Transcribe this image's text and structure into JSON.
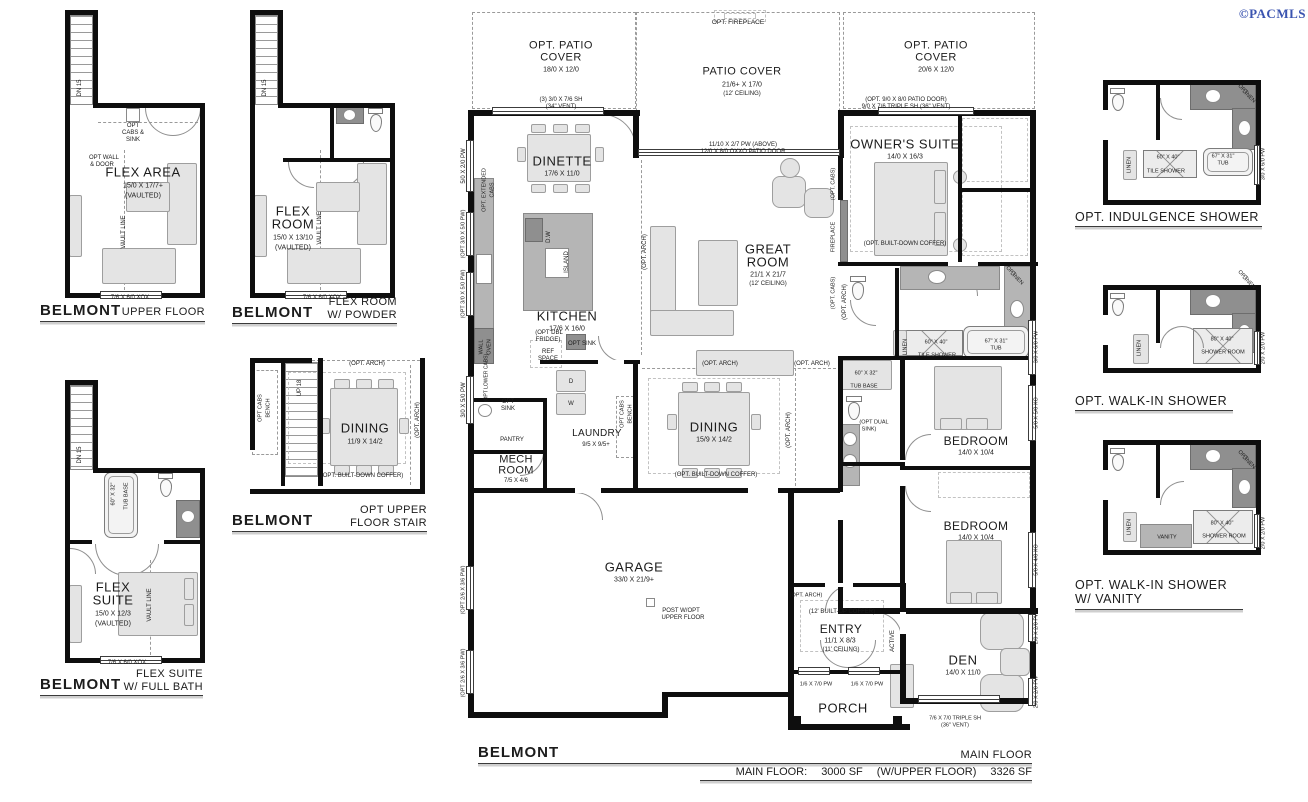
{
  "copyright": "©PACMLS",
  "plans": {
    "upper_floor": {
      "brand": "BELMONT",
      "label": "UPPER FLOOR"
    },
    "flex_powder": {
      "brand": "BELMONT",
      "label": "FLEX ROOM",
      "label2": "W/ POWDER"
    },
    "flex_suite": {
      "brand": "BELMONT",
      "label": "FLEX SUITE",
      "label2": "W/ FULL BATH"
    },
    "opt_stair": {
      "brand": "BELMONT",
      "label": "OPT UPPER",
      "label2": "FLOOR STAIR"
    },
    "indulgence": {
      "label": "OPT. INDULGENCE SHOWER"
    },
    "walkin": {
      "label": "OPT. WALK-IN SHOWER"
    },
    "walkin_vanity": {
      "label": "OPT. WALK-IN SHOWER",
      "label2": "W/ VANITY"
    }
  },
  "footer": {
    "brand": "BELMONT",
    "floor_label": "MAIN FLOOR",
    "area_label": "MAIN FLOOR:",
    "area_main": "3000 SF",
    "area_with": "(W/UPPER FLOOR)",
    "area_total": "3326 SF"
  },
  "labels": [
    {
      "t": "FLEX AREA",
      "x": 143,
      "y": 172,
      "fs": 13,
      "sp": 0.5,
      "n": "room-flex-area"
    },
    {
      "t": "15/0 X 17/7+",
      "x": 143,
      "y": 186,
      "fs": 7
    },
    {
      "t": "(VAULTED)",
      "x": 143,
      "y": 196,
      "fs": 7
    },
    {
      "t": "OPT",
      "x": 133,
      "y": 126,
      "fs": 6
    },
    {
      "t": "CABS &",
      "x": 133,
      "y": 133,
      "fs": 6
    },
    {
      "t": "SINK",
      "x": 133,
      "y": 140,
      "fs": 6
    },
    {
      "t": "OPT WALL",
      "x": 104,
      "y": 158,
      "fs": 6
    },
    {
      "t": "& DOOR",
      "x": 102,
      "y": 165,
      "fs": 6
    },
    {
      "t": "VAULT LINE",
      "x": 124,
      "y": 232,
      "fs": 6,
      "r": -90
    },
    {
      "t": "DN 15",
      "x": 80,
      "y": 88,
      "fs": 6,
      "r": -90
    },
    {
      "t": "7/6 X 6/0 XOX",
      "x": 130,
      "y": 298,
      "fs": 6
    },
    {
      "t": "FLEX",
      "x": 293,
      "y": 211,
      "fs": 13,
      "sp": 0.5,
      "n": "room-flex-room"
    },
    {
      "t": "ROOM",
      "x": 293,
      "y": 224,
      "fs": 13,
      "sp": 0.5
    },
    {
      "t": "15/0 X 13/10",
      "x": 293,
      "y": 238,
      "fs": 7
    },
    {
      "t": "(VAULTED)",
      "x": 293,
      "y": 248,
      "fs": 7
    },
    {
      "t": "VAULT LINE",
      "x": 320,
      "y": 228,
      "fs": 6,
      "r": -90
    },
    {
      "t": "DN 15",
      "x": 265,
      "y": 88,
      "fs": 6,
      "r": -90
    },
    {
      "t": "7/6 X 6/0 XOX",
      "x": 322,
      "y": 298,
      "fs": 6
    },
    {
      "t": "FLEX",
      "x": 113,
      "y": 587,
      "fs": 13,
      "sp": 0.5,
      "n": "room-flex-suite"
    },
    {
      "t": "SUITE",
      "x": 113,
      "y": 600,
      "fs": 13,
      "sp": 0.5
    },
    {
      "t": "15/0 X 12/3",
      "x": 113,
      "y": 614,
      "fs": 7
    },
    {
      "t": "(VAULTED)",
      "x": 113,
      "y": 624,
      "fs": 7
    },
    {
      "t": "60\" X 32\"",
      "x": 114,
      "y": 494,
      "fs": 5.5,
      "r": -90
    },
    {
      "t": "TUB BASE",
      "x": 127,
      "y": 496,
      "fs": 5.5,
      "r": -90
    },
    {
      "t": "VAULT LINE",
      "x": 150,
      "y": 605,
      "fs": 6,
      "r": -90
    },
    {
      "t": "DN 15",
      "x": 80,
      "y": 455,
      "fs": 6,
      "r": -90
    },
    {
      "t": "7/6 X 6/0 XOX",
      "x": 127,
      "y": 663,
      "fs": 6
    },
    {
      "t": "(OPT. ARCH)",
      "x": 367,
      "y": 364,
      "fs": 6
    },
    {
      "t": "OPT CABS",
      "x": 261,
      "y": 408,
      "fs": 5.5,
      "r": -90
    },
    {
      "t": "BENCH",
      "x": 269,
      "y": 408,
      "fs": 5.5,
      "r": -90
    },
    {
      "t": "UP 18",
      "x": 300,
      "y": 388,
      "fs": 6,
      "r": -90
    },
    {
      "t": "DINING",
      "x": 365,
      "y": 428,
      "fs": 13,
      "sp": 0.5,
      "n": "room-dining-opt"
    },
    {
      "t": "11/9 X 14/2",
      "x": 365,
      "y": 442,
      "fs": 7
    },
    {
      "t": "(OPT. BUILT-DOWN COFFER)",
      "x": 362,
      "y": 476,
      "fs": 6
    },
    {
      "t": "(OPT. ARCH)",
      "x": 418,
      "y": 420,
      "fs": 6,
      "r": -90
    },
    {
      "t": "OPT. PATIO",
      "x": 561,
      "y": 46,
      "fs": 11,
      "sp": 0.5,
      "n": "area-opt-patio-cover-left"
    },
    {
      "t": "COVER",
      "x": 561,
      "y": 58,
      "fs": 11,
      "sp": 0.5
    },
    {
      "t": "18/0 X 12/0",
      "x": 561,
      "y": 70,
      "fs": 7
    },
    {
      "t": "(3) 3/0 X 7/6 SH",
      "x": 561,
      "y": 100,
      "fs": 6
    },
    {
      "t": "(34\" VENT)",
      "x": 561,
      "y": 107,
      "fs": 6
    },
    {
      "t": "OPT. FIREPLACE",
      "x": 738,
      "y": 23,
      "fs": 6.5
    },
    {
      "t": "PATIO COVER",
      "x": 742,
      "y": 72,
      "fs": 11,
      "sp": 0.5,
      "n": "area-patio-cover"
    },
    {
      "t": "21/6+ X 17/0",
      "x": 742,
      "y": 85,
      "fs": 7
    },
    {
      "t": "(12' CEILING)",
      "x": 742,
      "y": 94,
      "fs": 6
    },
    {
      "t": "11/10 X 2/7 PW (ABOVE)",
      "x": 743,
      "y": 145,
      "fs": 6
    },
    {
      "t": "12/0 X 8/0 OXXO PATIO DOOR",
      "x": 743,
      "y": 152,
      "fs": 6
    },
    {
      "t": "OPT. PATIO",
      "x": 936,
      "y": 46,
      "fs": 11,
      "sp": 0.5,
      "n": "area-opt-patio-cover-right"
    },
    {
      "t": "COVER",
      "x": 936,
      "y": 58,
      "fs": 11,
      "sp": 0.5
    },
    {
      "t": "20/6 X 12/0",
      "x": 936,
      "y": 70,
      "fs": 7
    },
    {
      "t": "(OPT. 9/0 X 8/0 PATIO DOOR)",
      "x": 906,
      "y": 100,
      "fs": 6
    },
    {
      "t": "9/0 X 7/6 TRIPLE SH (36\" VENT)",
      "x": 906,
      "y": 107,
      "fs": 6
    },
    {
      "t": "DINETTE",
      "x": 562,
      "y": 161,
      "fs": 13,
      "sp": 0.5,
      "n": "room-dinette"
    },
    {
      "t": "17/6 X 11/0",
      "x": 562,
      "y": 174,
      "fs": 7
    },
    {
      "t": "KITCHEN",
      "x": 567,
      "y": 316,
      "fs": 13,
      "sp": 0.5,
      "n": "room-kitchen"
    },
    {
      "t": "17/6 X 16/0",
      "x": 567,
      "y": 329,
      "fs": 7
    },
    {
      "t": "ISLAND",
      "x": 567,
      "y": 262,
      "fs": 6,
      "r": -90
    },
    {
      "t": "D.W",
      "x": 549,
      "y": 237,
      "fs": 6,
      "r": -90
    },
    {
      "t": "(OPT DBL",
      "x": 549,
      "y": 333,
      "fs": 6
    },
    {
      "t": "FRIDGE)",
      "x": 548,
      "y": 340,
      "fs": 6
    },
    {
      "t": "REF",
      "x": 548,
      "y": 352,
      "fs": 6
    },
    {
      "t": "SPACE",
      "x": 548,
      "y": 359,
      "fs": 6
    },
    {
      "t": "OPT SINK",
      "x": 582,
      "y": 344,
      "fs": 6
    },
    {
      "t": "GREAT",
      "x": 768,
      "y": 249,
      "fs": 13,
      "sp": 0.5,
      "n": "room-great-room"
    },
    {
      "t": "ROOM",
      "x": 768,
      "y": 262,
      "fs": 13,
      "sp": 0.5
    },
    {
      "t": "21/1 X 21/7",
      "x": 768,
      "y": 275,
      "fs": 7
    },
    {
      "t": "(12' CEILING)",
      "x": 768,
      "y": 284,
      "fs": 6
    },
    {
      "t": "FIREPLACE",
      "x": 834,
      "y": 237,
      "fs": 5.5,
      "r": -90
    },
    {
      "t": "(OPT. CABS)",
      "x": 834,
      "y": 184,
      "fs": 5.5,
      "r": -90
    },
    {
      "t": "(OPT. CABS)",
      "x": 834,
      "y": 293,
      "fs": 5.5,
      "r": -90
    },
    {
      "t": "OWNER'S SUITE",
      "x": 905,
      "y": 144,
      "fs": 13,
      "sp": 0.5,
      "n": "room-owners-suite"
    },
    {
      "t": "14/0 X 16/3",
      "x": 905,
      "y": 157,
      "fs": 7
    },
    {
      "t": "(OPT. BUILT-DOWN COFFER)",
      "x": 905,
      "y": 244,
      "fs": 6
    },
    {
      "t": "(OPT. ARCH)",
      "x": 645,
      "y": 252,
      "fs": 6,
      "r": -90
    },
    {
      "t": "(OPT. ARCH)",
      "x": 845,
      "y": 302,
      "fs": 6,
      "r": -90
    },
    {
      "t": "(OPT. ARCH)",
      "x": 720,
      "y": 364,
      "fs": 6
    },
    {
      "t": "(OPT. ARCH)",
      "x": 812,
      "y": 364,
      "fs": 6
    },
    {
      "t": "(OPT. ARCH)",
      "x": 789,
      "y": 430,
      "fs": 6,
      "r": -90
    },
    {
      "t": "(OPT. ARCH)",
      "x": 806,
      "y": 596,
      "fs": 5.5
    },
    {
      "t": "DINING",
      "x": 714,
      "y": 427,
      "fs": 13,
      "sp": 0.5,
      "n": "room-dining"
    },
    {
      "t": "15/9 X 14/2",
      "x": 714,
      "y": 440,
      "fs": 7
    },
    {
      "t": "(OPT. BUILT-DOWN COFFER)",
      "x": 716,
      "y": 475,
      "fs": 6
    },
    {
      "t": "OPT CABS",
      "x": 623,
      "y": 414,
      "fs": 5.5,
      "r": -90
    },
    {
      "t": "BENCH",
      "x": 631,
      "y": 414,
      "fs": 5.5,
      "r": -90
    },
    {
      "t": "LAUNDRY",
      "x": 597,
      "y": 434,
      "fs": 10,
      "sp": 0.3,
      "n": "room-laundry"
    },
    {
      "t": "9/5 X 9/5+",
      "x": 596,
      "y": 445,
      "fs": 6
    },
    {
      "t": "D",
      "x": 571,
      "y": 382,
      "fs": 6
    },
    {
      "t": "W",
      "x": 571,
      "y": 404,
      "fs": 6
    },
    {
      "t": "PANTRY",
      "x": 512,
      "y": 440,
      "fs": 6
    },
    {
      "t": "OPT",
      "x": 508,
      "y": 402,
      "fs": 6
    },
    {
      "t": "SINK",
      "x": 508,
      "y": 409,
      "fs": 6
    },
    {
      "t": "MECH",
      "x": 516,
      "y": 460,
      "fs": 11,
      "sp": 0.3,
      "n": "room-mech"
    },
    {
      "t": "ROOM",
      "x": 516,
      "y": 471,
      "fs": 11,
      "sp": 0.3
    },
    {
      "t": "7/5 X 4/6",
      "x": 516,
      "y": 481,
      "fs": 6
    },
    {
      "t": "WALL",
      "x": 482,
      "y": 347,
      "fs": 5.5,
      "r": -90
    },
    {
      "t": "OVEN",
      "x": 490,
      "y": 347,
      "fs": 5.5,
      "r": -90
    },
    {
      "t": "(OPT LOWER CABS)",
      "x": 487,
      "y": 378,
      "fs": 5,
      "r": -90
    },
    {
      "t": "OPT. EXTENDED",
      "x": 485,
      "y": 190,
      "fs": 5.5,
      "r": -90
    },
    {
      "t": "CABS",
      "x": 493,
      "y": 190,
      "fs": 5.5,
      "r": -90
    },
    {
      "t": "5/0 X 2/0 PW",
      "x": 464,
      "y": 166,
      "fs": 6,
      "r": -90
    },
    {
      "t": "(OPT 3/0 X 5/0 PW)",
      "x": 464,
      "y": 234,
      "fs": 5.5,
      "r": -90
    },
    {
      "t": "(OPT 3/0 X 5/0 PW)",
      "x": 464,
      "y": 294,
      "fs": 5.5,
      "r": -90
    },
    {
      "t": "3/0 X 5/0 PW",
      "x": 464,
      "y": 400,
      "fs": 6,
      "r": -90
    },
    {
      "t": "(OPT 2/6 X 3/6 PW)",
      "x": 464,
      "y": 590,
      "fs": 5.5,
      "r": -90
    },
    {
      "t": "(OPT 2/6 X 3/6 PW)",
      "x": 464,
      "y": 673,
      "fs": 5.5,
      "r": -90
    },
    {
      "t": "GARAGE",
      "x": 634,
      "y": 567,
      "fs": 13,
      "sp": 0.5,
      "n": "room-garage"
    },
    {
      "t": "33/0 X 21/9+",
      "x": 634,
      "y": 580,
      "fs": 7
    },
    {
      "t": "POST W/OPT",
      "x": 681,
      "y": 611,
      "fs": 6
    },
    {
      "t": "UPPER FLOOR",
      "x": 683,
      "y": 618,
      "fs": 6
    },
    {
      "t": "ENTRY",
      "x": 841,
      "y": 629,
      "fs": 12,
      "sp": 0.4,
      "n": "room-entry"
    },
    {
      "t": "11/1 X 8/3",
      "x": 840,
      "y": 641,
      "fs": 7
    },
    {
      "t": "(11' CEILING)",
      "x": 841,
      "y": 650,
      "fs": 6
    },
    {
      "t": "(12' BUILT-UP COFFER)",
      "x": 842,
      "y": 612,
      "fs": 6
    },
    {
      "t": "ACTIVE",
      "x": 893,
      "y": 641,
      "fs": 6,
      "r": -90
    },
    {
      "t": "1/6 X 7/0 PW",
      "x": 816,
      "y": 685,
      "fs": 5.5
    },
    {
      "t": "1/6 X 7/0 PW",
      "x": 867,
      "y": 685,
      "fs": 5.5
    },
    {
      "t": "PORCH",
      "x": 843,
      "y": 708,
      "fs": 13,
      "sp": 0.5,
      "n": "room-porch"
    },
    {
      "t": "DEN",
      "x": 963,
      "y": 660,
      "fs": 13,
      "sp": 0.5,
      "n": "room-den"
    },
    {
      "t": "14/0 X 11/0",
      "x": 963,
      "y": 673,
      "fs": 7
    },
    {
      "t": "7/6 X 7/0 TRIPLE SH",
      "x": 955,
      "y": 719,
      "fs": 5.5
    },
    {
      "t": "(36\" VENT)",
      "x": 955,
      "y": 726,
      "fs": 5.5
    },
    {
      "t": "BEDROOM",
      "x": 976,
      "y": 441,
      "fs": 12,
      "sp": 0.4,
      "n": "room-bedroom-1"
    },
    {
      "t": "14/0 X 10/4",
      "x": 976,
      "y": 453,
      "fs": 7
    },
    {
      "t": "BEDROOM",
      "x": 976,
      "y": 526,
      "fs": 12,
      "sp": 0.4,
      "n": "room-bedroom-2"
    },
    {
      "t": "14/0 X 10/4",
      "x": 976,
      "y": 538,
      "fs": 7
    },
    {
      "t": "60\" X 40\"",
      "x": 936,
      "y": 343,
      "fs": 5.5
    },
    {
      "t": "TILE SHOWER",
      "x": 937,
      "y": 356,
      "fs": 5.5
    },
    {
      "t": "67\" X 31\"",
      "x": 996,
      "y": 342,
      "fs": 5.5
    },
    {
      "t": "TUB",
      "x": 996,
      "y": 349,
      "fs": 5.5
    },
    {
      "t": "LINEN",
      "x": 906,
      "y": 347,
      "fs": 5.5,
      "r": -90
    },
    {
      "t": "OPT",
      "x": 1010,
      "y": 272,
      "fs": 5.5,
      "r": 45
    },
    {
      "t": "LINEN",
      "x": 1016,
      "y": 279,
      "fs": 5.5,
      "r": 45
    },
    {
      "t": "3/0 X 6/0 PW",
      "x": 1037,
      "y": 347,
      "fs": 5.5,
      "r": -90
    },
    {
      "t": "5/0 X 5/0 XO",
      "x": 1037,
      "y": 413,
      "fs": 5.5,
      "r": -90
    },
    {
      "t": "5/0 X 4/0 XO",
      "x": 1037,
      "y": 560,
      "fs": 5.5,
      "r": -90
    },
    {
      "t": "2/0 X 2/0 PW",
      "x": 1037,
      "y": 628,
      "fs": 5.5,
      "r": -90
    },
    {
      "t": "2/0 X 2/0 PW",
      "x": 1037,
      "y": 692,
      "fs": 5.5,
      "r": -90
    },
    {
      "t": "60\" X 32\"",
      "x": 866,
      "y": 374,
      "fs": 5.5
    },
    {
      "t": "TUB BASE",
      "x": 864,
      "y": 387,
      "fs": 5.5
    },
    {
      "t": "(OPT DUAL",
      "x": 874,
      "y": 423,
      "fs": 5.5
    },
    {
      "t": "SINK)",
      "x": 869,
      "y": 430,
      "fs": 5.5
    },
    {
      "t": "60\" X 40\"",
      "x": 1168,
      "y": 158,
      "fs": 5.5
    },
    {
      "t": "TILE SHOWER",
      "x": 1166,
      "y": 172,
      "fs": 5.5
    },
    {
      "t": "67\" X 31\"",
      "x": 1223,
      "y": 157,
      "fs": 5.5
    },
    {
      "t": "TUB",
      "x": 1223,
      "y": 164,
      "fs": 5.5
    },
    {
      "t": "LINEN",
      "x": 1130,
      "y": 165,
      "fs": 5.5,
      "r": -90
    },
    {
      "t": "OPT",
      "x": 1242,
      "y": 90,
      "fs": 5.5,
      "r": 45
    },
    {
      "t": "LINEN",
      "x": 1248,
      "y": 97,
      "fs": 5.5,
      "r": 45
    },
    {
      "t": "3/0 X 6/0 PW",
      "x": 1264,
      "y": 164,
      "fs": 5.5,
      "r": -90
    },
    {
      "t": "80\" X 40\"",
      "x": 1222,
      "y": 340,
      "fs": 5.5
    },
    {
      "t": "SHOWER ROOM",
      "x": 1223,
      "y": 353,
      "fs": 5.5
    },
    {
      "t": "LINEN",
      "x": 1140,
      "y": 348,
      "fs": 5.5,
      "r": -90
    },
    {
      "t": "OPT",
      "x": 1242,
      "y": 276,
      "fs": 5.5,
      "r": 45
    },
    {
      "t": "LINEN",
      "x": 1248,
      "y": 283,
      "fs": 5.5,
      "r": 45
    },
    {
      "t": "2/0 X 2/0 PW",
      "x": 1264,
      "y": 348,
      "fs": 5.5,
      "r": -90
    },
    {
      "t": "80\" X 40\"",
      "x": 1222,
      "y": 524,
      "fs": 5.5
    },
    {
      "t": "SHOWER ROOM",
      "x": 1224,
      "y": 537,
      "fs": 5.5
    },
    {
      "t": "VANITY",
      "x": 1167,
      "y": 538,
      "fs": 5.5
    },
    {
      "t": "LINEN",
      "x": 1130,
      "y": 527,
      "fs": 5.5,
      "r": -90
    },
    {
      "t": "OPT",
      "x": 1242,
      "y": 456,
      "fs": 5.5,
      "r": 45
    },
    {
      "t": "LINEN",
      "x": 1248,
      "y": 463,
      "fs": 5.5,
      "r": 45
    },
    {
      "t": "2/0 X 2/0 PW",
      "x": 1264,
      "y": 533,
      "fs": 5.5,
      "r": -90
    }
  ]
}
